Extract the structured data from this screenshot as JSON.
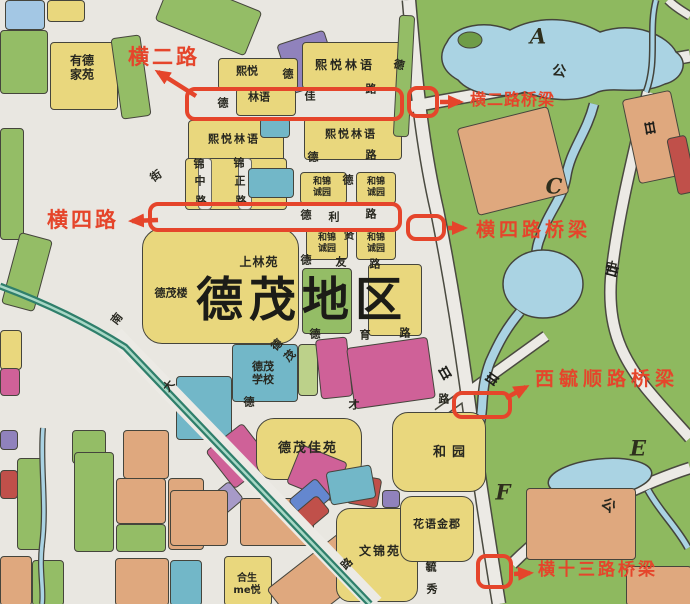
{
  "title_region": "德茂地区",
  "annotations": {
    "accent_color": "#e5452b",
    "items": [
      {
        "label": "横二路"
      },
      {
        "label": "横二路桥梁"
      },
      {
        "label": "横四路"
      },
      {
        "label": "横四路桥梁"
      },
      {
        "label": "西毓顺路桥梁"
      },
      {
        "label": "横十三路桥梁"
      }
    ]
  },
  "map": {
    "palette": {
      "y": "#e9d77d",
      "g": "#94bd66",
      "t": "#72b7c8",
      "b": "#a3c7e4",
      "o": "#dfa87e",
      "m": "#cf6198",
      "p": "#9082bc",
      "lp": "#a79ac8",
      "r": "#c0504a",
      "lg": "#bcd18a",
      "db": "#6487cf",
      "bg": "#e9e7e1",
      "water": "#aad3e3",
      "green_area": "#8eb95f",
      "rail": "#2f7f6b",
      "road": "#eceae5",
      "outline": "#45453c"
    },
    "region_letters": [
      {
        "t": "A",
        "x": 538,
        "y": 36
      },
      {
        "t": "C",
        "x": 554,
        "y": 186
      },
      {
        "t": "E",
        "x": 638,
        "y": 448
      },
      {
        "t": "F",
        "x": 503,
        "y": 492
      }
    ],
    "estate_labels": [
      {
        "t": "德茂地区",
        "x": 302,
        "y": 301,
        "s": 47,
        "ls": 6,
        "big": true
      },
      {
        "t": "有德\n家苑",
        "x": 82,
        "y": 68,
        "s": 12
      },
      {
        "t": "熙悦",
        "x": 247,
        "y": 71,
        "s": 11
      },
      {
        "t": "林语",
        "x": 259,
        "y": 97,
        "s": 11
      },
      {
        "t": "熙悦林语",
        "x": 345,
        "y": 65,
        "s": 12,
        "ls": 3
      },
      {
        "t": "熙悦林语",
        "x": 234,
        "y": 139,
        "s": 11,
        "ls": 2
      },
      {
        "t": "熙悦林语",
        "x": 351,
        "y": 134,
        "s": 11,
        "ls": 2
      },
      {
        "t": "和锦\n诚园",
        "x": 322,
        "y": 188,
        "s": 9
      },
      {
        "t": "和锦\n诚园",
        "x": 376,
        "y": 188,
        "s": 9
      },
      {
        "t": "和锦\n诚园",
        "x": 327,
        "y": 244,
        "s": 9
      },
      {
        "t": "和锦\n诚园",
        "x": 376,
        "y": 244,
        "s": 9
      },
      {
        "t": "上林苑",
        "x": 259,
        "y": 262,
        "s": 12,
        "ls": 1
      },
      {
        "t": "德茂楼",
        "x": 171,
        "y": 293,
        "s": 11
      },
      {
        "t": "德茂\n学校",
        "x": 263,
        "y": 373,
        "s": 11
      },
      {
        "t": "德茂佳苑",
        "x": 308,
        "y": 449,
        "s": 13,
        "ls": 2
      },
      {
        "t": "和园",
        "x": 452,
        "y": 453,
        "s": 13,
        "ls": 6
      },
      {
        "t": "花语金郡",
        "x": 437,
        "y": 524,
        "s": 11,
        "ls": 1
      },
      {
        "t": "文锦苑",
        "x": 380,
        "y": 551,
        "s": 12,
        "ls": 2
      },
      {
        "t": "合生\nme悦",
        "x": 247,
        "y": 585,
        "s": 10
      }
    ],
    "street_chars": [
      {
        "t": "德",
        "x": 223,
        "y": 103
      },
      {
        "t": "佳",
        "x": 310,
        "y": 96
      },
      {
        "t": "路",
        "x": 371,
        "y": 89
      },
      {
        "t": "德",
        "x": 288,
        "y": 74
      },
      {
        "t": "德",
        "x": 399,
        "y": 65,
        "r": 15
      },
      {
        "t": "德",
        "x": 313,
        "y": 157
      },
      {
        "t": "路",
        "x": 371,
        "y": 155
      },
      {
        "t": "锦",
        "x": 199,
        "y": 164
      },
      {
        "t": "中",
        "x": 200,
        "y": 181
      },
      {
        "t": "路",
        "x": 201,
        "y": 201
      },
      {
        "t": "锦",
        "x": 239,
        "y": 163
      },
      {
        "t": "正",
        "x": 240,
        "y": 181
      },
      {
        "t": "路",
        "x": 241,
        "y": 201
      },
      {
        "t": "德",
        "x": 306,
        "y": 215
      },
      {
        "t": "利",
        "x": 334,
        "y": 217
      },
      {
        "t": "路",
        "x": 371,
        "y": 214
      },
      {
        "t": "德",
        "x": 348,
        "y": 180
      },
      {
        "t": "贤",
        "x": 349,
        "y": 235
      },
      {
        "t": "德",
        "x": 306,
        "y": 260
      },
      {
        "t": "友",
        "x": 341,
        "y": 262
      },
      {
        "t": "路",
        "x": 375,
        "y": 264
      },
      {
        "t": "德",
        "x": 315,
        "y": 334
      },
      {
        "t": "育",
        "x": 365,
        "y": 335
      },
      {
        "t": "路",
        "x": 405,
        "y": 333
      },
      {
        "t": "德",
        "x": 249,
        "y": 402
      },
      {
        "t": "才",
        "x": 354,
        "y": 405
      },
      {
        "t": "路",
        "x": 444,
        "y": 399
      },
      {
        "t": "街",
        "x": 156,
        "y": 176,
        "r": -35
      },
      {
        "t": "南",
        "x": 117,
        "y": 319,
        "r": -52
      },
      {
        "t": "大",
        "x": 169,
        "y": 386,
        "r": -52
      },
      {
        "t": "德",
        "x": 277,
        "y": 345,
        "r": -45
      },
      {
        "t": "茂",
        "x": 290,
        "y": 356,
        "r": -45
      },
      {
        "t": "路",
        "x": 347,
        "y": 564,
        "r": -45
      },
      {
        "t": "毓",
        "x": 431,
        "y": 567
      },
      {
        "t": "秀",
        "x": 432,
        "y": 589
      },
      {
        "t": "中",
        "x": 611,
        "y": 267,
        "r": 12,
        "s": 12
      },
      {
        "t": "公",
        "x": 559,
        "y": 72,
        "r": 8,
        "s": 14
      },
      {
        "t": "公",
        "x": 608,
        "y": 506,
        "r": 38,
        "s": 14
      }
    ],
    "blocks": [
      {
        "x": 5,
        "y": 0,
        "w": 38,
        "h": 28,
        "c": "b"
      },
      {
        "x": 47,
        "y": 0,
        "w": 36,
        "h": 20,
        "c": "y"
      },
      {
        "x": 160,
        "y": -8,
        "w": 95,
        "h": 46,
        "c": "g",
        "rot": 22
      },
      {
        "x": 0,
        "y": 30,
        "w": 46,
        "h": 62,
        "c": "g"
      },
      {
        "x": 50,
        "y": 42,
        "w": 66,
        "h": 66,
        "c": "y"
      },
      {
        "x": 116,
        "y": 36,
        "w": 28,
        "h": 80,
        "c": "g",
        "rot": -8
      },
      {
        "x": 0,
        "y": 128,
        "w": 22,
        "h": 110,
        "c": "g"
      },
      {
        "x": 10,
        "y": 235,
        "w": 32,
        "h": 72,
        "c": "g",
        "rot": 15
      },
      {
        "x": 0,
        "y": 330,
        "w": 20,
        "h": 38,
        "c": "y"
      },
      {
        "x": 0,
        "y": 368,
        "w": 18,
        "h": 26,
        "c": "m"
      },
      {
        "x": 283,
        "y": 36,
        "w": 48,
        "h": 50,
        "c": "p",
        "rot": -18
      },
      {
        "x": 302,
        "y": 42,
        "w": 100,
        "h": 45,
        "c": "y"
      },
      {
        "x": 218,
        "y": 58,
        "w": 78,
        "h": 30,
        "c": "y"
      },
      {
        "x": 236,
        "y": 88,
        "w": 58,
        "h": 26,
        "c": "y"
      },
      {
        "x": 188,
        "y": 120,
        "w": 94,
        "h": 42,
        "c": "y"
      },
      {
        "x": 260,
        "y": 118,
        "w": 28,
        "h": 18,
        "c": "t"
      },
      {
        "x": 304,
        "y": 118,
        "w": 96,
        "h": 40,
        "c": "y"
      },
      {
        "x": 396,
        "y": 15,
        "w": 14,
        "h": 120,
        "c": "g",
        "rot": 3
      },
      {
        "x": 185,
        "y": 158,
        "w": 100,
        "h": 50,
        "c": "y"
      },
      {
        "x": 198,
        "y": 158,
        "w": 12,
        "h": 50,
        "c": "bg"
      },
      {
        "x": 238,
        "y": 158,
        "w": 12,
        "h": 50,
        "c": "bg"
      },
      {
        "x": 248,
        "y": 168,
        "w": 44,
        "h": 28,
        "c": "t"
      },
      {
        "x": 300,
        "y": 172,
        "w": 45,
        "h": 30,
        "c": "y"
      },
      {
        "x": 356,
        "y": 172,
        "w": 38,
        "h": 30,
        "c": "y"
      },
      {
        "x": 306,
        "y": 228,
        "w": 40,
        "h": 30,
        "c": "y"
      },
      {
        "x": 356,
        "y": 228,
        "w": 38,
        "h": 30,
        "c": "y"
      },
      {
        "x": 142,
        "y": 228,
        "w": 155,
        "h": 114,
        "c": "y",
        "br": 20
      },
      {
        "x": 302,
        "y": 268,
        "w": 48,
        "h": 64,
        "c": "g"
      },
      {
        "x": 368,
        "y": 264,
        "w": 52,
        "h": 70,
        "c": "y"
      },
      {
        "x": 232,
        "y": 344,
        "w": 64,
        "h": 56,
        "c": "t"
      },
      {
        "x": 298,
        "y": 344,
        "w": 18,
        "h": 50,
        "c": "lg"
      },
      {
        "x": 318,
        "y": 338,
        "w": 30,
        "h": 58,
        "c": "m",
        "rot": -6
      },
      {
        "x": 350,
        "y": 342,
        "w": 80,
        "h": 60,
        "c": "m",
        "rot": -8
      },
      {
        "x": 176,
        "y": 376,
        "w": 54,
        "h": 62,
        "c": "t"
      },
      {
        "x": 215,
        "y": 432,
        "w": 45,
        "h": 46,
        "c": "m",
        "rot": -38
      },
      {
        "x": 256,
        "y": 418,
        "w": 104,
        "h": 60,
        "c": "y",
        "br": 18
      },
      {
        "x": 392,
        "y": 412,
        "w": 92,
        "h": 78,
        "c": "y",
        "br": 16
      },
      {
        "x": 292,
        "y": 452,
        "w": 48,
        "h": 40,
        "c": "m",
        "rot": 22
      },
      {
        "x": 348,
        "y": 476,
        "w": 30,
        "h": 28,
        "c": "r",
        "rot": 10
      },
      {
        "x": 382,
        "y": 490,
        "w": 16,
        "h": 16,
        "c": "p"
      },
      {
        "x": 328,
        "y": 468,
        "w": 44,
        "h": 32,
        "c": "t",
        "rot": -10
      },
      {
        "x": 0,
        "y": 430,
        "w": 16,
        "h": 18,
        "c": "p"
      },
      {
        "x": 123,
        "y": 430,
        "w": 44,
        "h": 47,
        "c": "o"
      },
      {
        "x": 0,
        "y": 470,
        "w": 16,
        "h": 27,
        "c": "r"
      },
      {
        "x": 17,
        "y": 458,
        "w": 26,
        "h": 90,
        "c": "g"
      },
      {
        "x": 72,
        "y": 430,
        "w": 32,
        "h": 32,
        "c": "g"
      },
      {
        "x": 74,
        "y": 452,
        "w": 38,
        "h": 98,
        "c": "g"
      },
      {
        "x": 116,
        "y": 478,
        "w": 48,
        "h": 44,
        "c": "o"
      },
      {
        "x": 116,
        "y": 524,
        "w": 48,
        "h": 26,
        "c": "g"
      },
      {
        "x": 168,
        "y": 478,
        "w": 34,
        "h": 70,
        "c": "o"
      },
      {
        "x": 0,
        "y": 556,
        "w": 30,
        "h": 48,
        "c": "o"
      },
      {
        "x": 32,
        "y": 560,
        "w": 30,
        "h": 44,
        "c": "g"
      },
      {
        "x": 115,
        "y": 558,
        "w": 52,
        "h": 46,
        "c": "o"
      },
      {
        "x": 170,
        "y": 560,
        "w": 30,
        "h": 44,
        "c": "t"
      },
      {
        "x": 203,
        "y": 490,
        "w": 36,
        "h": 22,
        "c": "lp",
        "rot": -40
      },
      {
        "x": 170,
        "y": 490,
        "w": 56,
        "h": 54,
        "c": "o"
      },
      {
        "x": 240,
        "y": 498,
        "w": 72,
        "h": 46,
        "c": "o"
      },
      {
        "x": 292,
        "y": 486,
        "w": 34,
        "h": 24,
        "c": "db",
        "rot": -40
      },
      {
        "x": 299,
        "y": 501,
        "w": 26,
        "h": 20,
        "c": "r",
        "rot": -40
      },
      {
        "x": 224,
        "y": 556,
        "w": 46,
        "h": 48,
        "c": "y"
      },
      {
        "x": 272,
        "y": 554,
        "w": 95,
        "h": 50,
        "c": "o",
        "rot": -38
      },
      {
        "x": 336,
        "y": 508,
        "w": 80,
        "h": 92,
        "c": "y",
        "br": 14
      },
      {
        "x": 400,
        "y": 496,
        "w": 72,
        "h": 64,
        "c": "y",
        "br": 12
      },
      {
        "x": 466,
        "y": 116,
        "w": 92,
        "h": 88,
        "c": "o",
        "rot": -14
      },
      {
        "x": 630,
        "y": 94,
        "w": 48,
        "h": 84,
        "c": "o",
        "rot": -12
      },
      {
        "x": 672,
        "y": 136,
        "w": 18,
        "h": 56,
        "c": "r",
        "rot": -12
      },
      {
        "x": 526,
        "y": 488,
        "w": 108,
        "h": 70,
        "c": "o"
      },
      {
        "x": 626,
        "y": 566,
        "w": 64,
        "h": 38,
        "c": "o"
      }
    ]
  }
}
